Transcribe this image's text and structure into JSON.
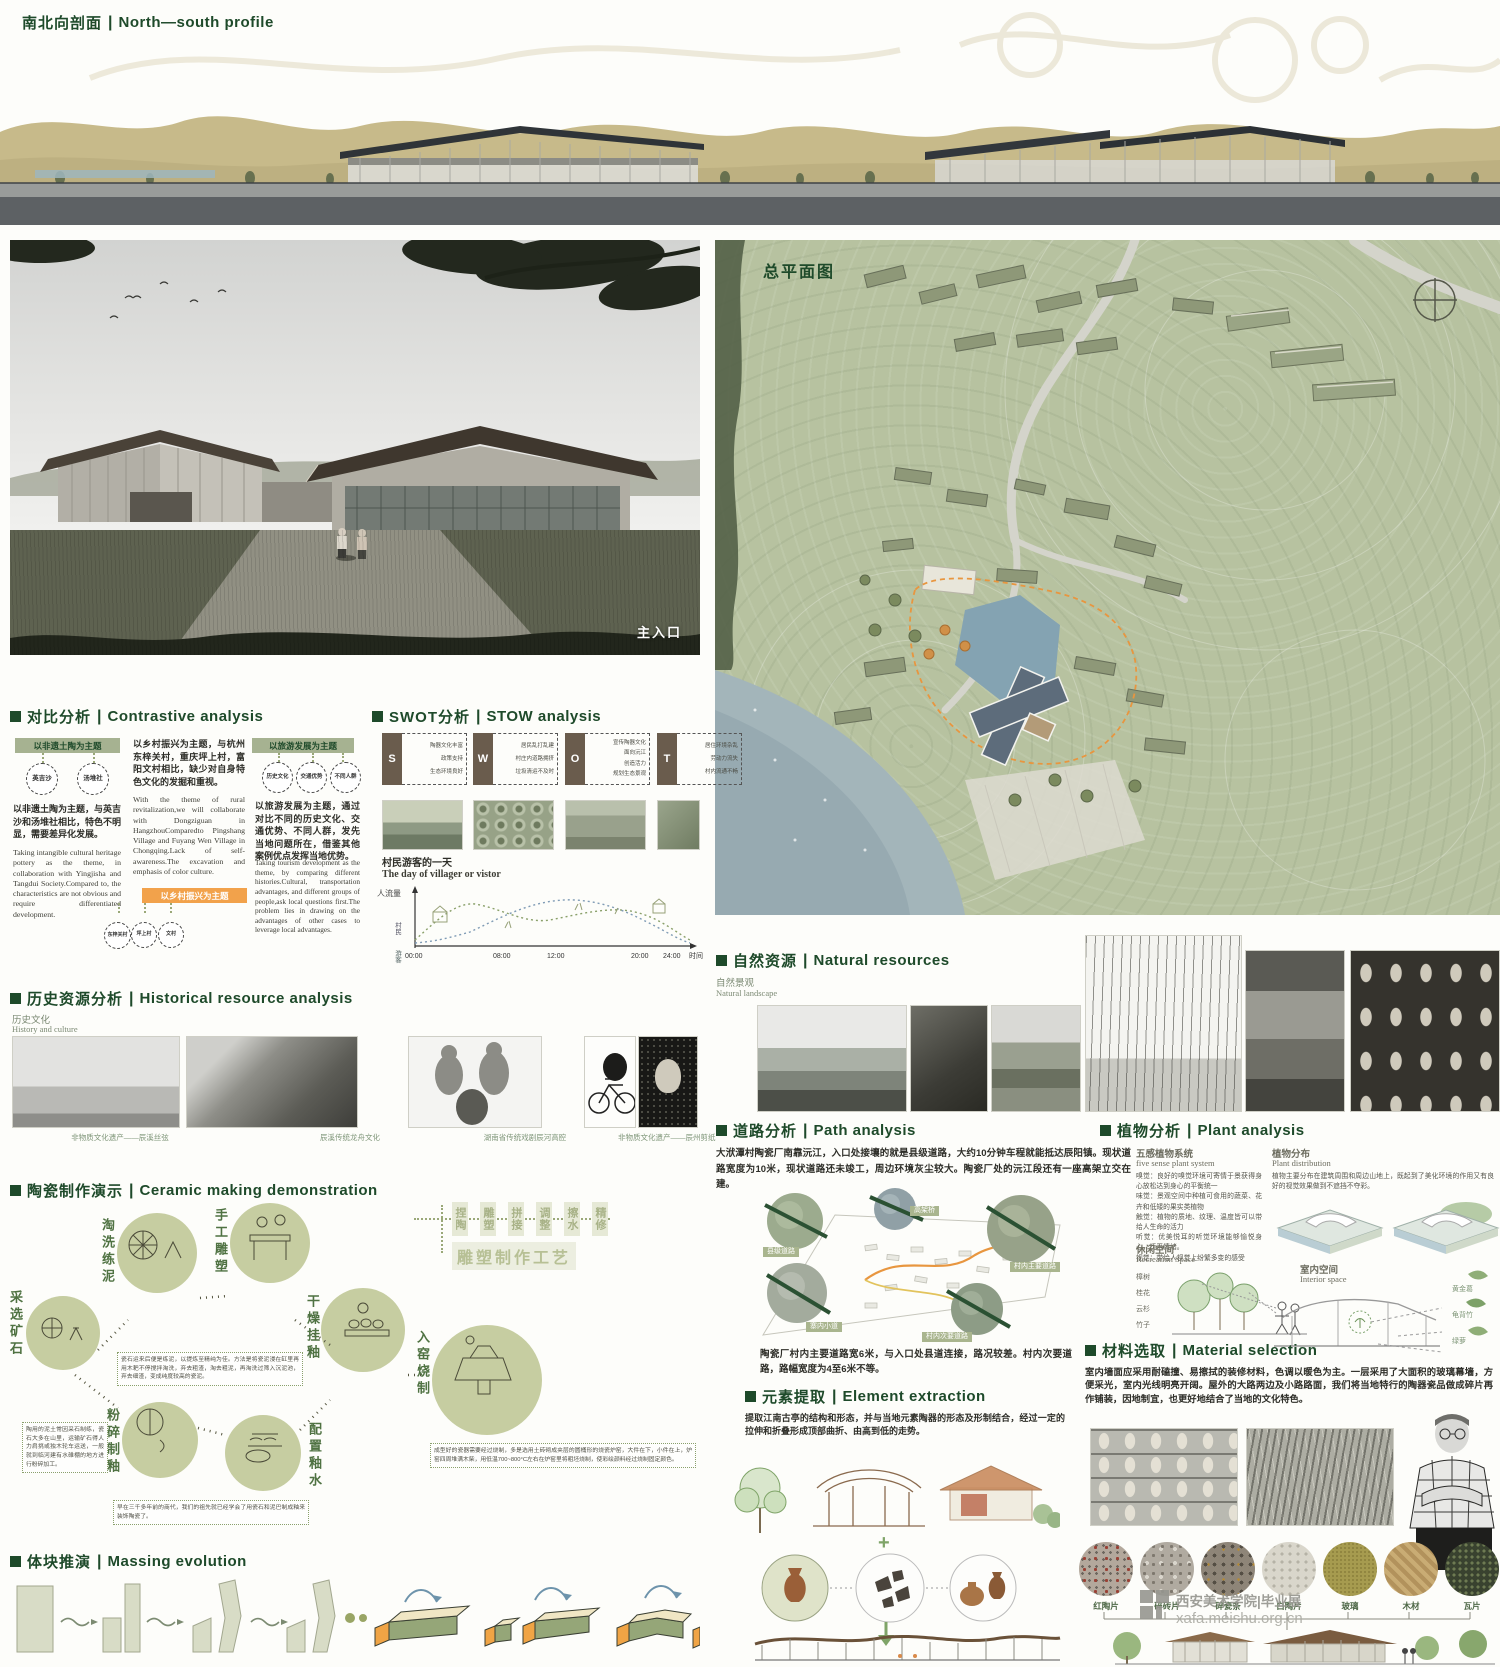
{
  "ui": {
    "sep": "|",
    "plus": "+"
  },
  "top": {
    "title_zh": "南北向剖面",
    "title_en": "North—south profile"
  },
  "render": {
    "entrance_label": "主入口"
  },
  "siteplan": {
    "title": "总平面图"
  },
  "contrastive": {
    "title_zh": "对比分析",
    "title_en": "Contrastive analysis",
    "card_pottery": {
      "header": "以非遗土陶为主题",
      "circle1": "英吉沙",
      "circle2": "汤堆社",
      "text_zh": "以非遗土陶为主题，与英吉沙和汤堆社相比，特色不明显，需要差异化发展。",
      "text_en": "Taking intangible cultural heritage pottery as the theme, in collaboration with Yingjisha and Tangdui Society.Compared to, the characteristics are not obvious and require differentiated development."
    },
    "card_rural": {
      "header": "以乡村振兴为主题",
      "circle1": "东梓关村",
      "circle2": "坪上村",
      "circle3": "文村",
      "text_zh": "以乡村振兴为主题，与杭州东梓关村，重庆坪上村，富阳文村相比，缺少对自身特色文化的发掘和重视。",
      "text_en": "With the theme of rural revitalization,we will collaborate with Dongziguan in HangzhouComparedto Pingshang Village and Fuyang Wen Village in Chongqing.Lack of self-awareness.The excavation and emphasis of color culture."
    },
    "card_tourism": {
      "header": "以旅游发展为主题",
      "circle1": "历史文化",
      "circle2": "交通优势",
      "circle3": "不同人群",
      "text_zh": "以旅游发展为主题，通过对比不同的历史文化、交通优势、不同人群，发先当地问题所在，借鉴其他案例优点发挥当地优势。",
      "text_en": "Taking tourism development as the theme, by comparing different histories.Cultural, transportation advantages, and different groups of people,ask local questions first.The problem lies in drawing on the advantages of other cases to leverage local advantages."
    }
  },
  "swot": {
    "title_zh": "SWOT分析",
    "title_en": "STOW analysis",
    "cards": [
      {
        "letter": "S",
        "i1": "陶器文化丰富",
        "i2": "政策支持",
        "i3": "生态环境良好"
      },
      {
        "letter": "W",
        "i1": "居民乱打乱建",
        "i2": "村庄内道路拥挤",
        "i3": "垃圾清运不及时"
      },
      {
        "letter": "O",
        "i1": "宣传陶器文化",
        "i2": "面向沅江",
        "i3": "创造活力",
        "i4": "规划生态景观"
      },
      {
        "letter": "T",
        "i1": "居住环境杂乱",
        "i2": "劳动力流失",
        "i3": "村内流通不畅"
      }
    ],
    "day": {
      "title_zh": "村民游客的一天",
      "title_en": "The day of villager or vistor",
      "y_label": "人流量",
      "x_label": "时间",
      "legend_villager": "村民",
      "legend_visitor": "游客",
      "ticks": [
        "00:00",
        "08:00",
        "12:00",
        "20:00",
        "24:00"
      ]
    },
    "day_chart": {
      "type": "line",
      "x_hours": [
        0,
        2,
        4,
        6,
        8,
        10,
        12,
        14,
        16,
        18,
        20,
        22,
        24
      ],
      "series": [
        {
          "name": "村民",
          "values": [
            0.1,
            0.1,
            0.2,
            0.6,
            0.7,
            0.5,
            0.45,
            0.5,
            0.6,
            0.5,
            0.3,
            0.15,
            0.1
          ]
        },
        {
          "name": "游客",
          "values": [
            0,
            0,
            0.05,
            0.1,
            0.4,
            0.7,
            0.8,
            0.75,
            0.7,
            0.5,
            0.25,
            0.1,
            0.05
          ]
        }
      ],
      "xlabel": "时间",
      "ylabel": "人流量"
    }
  },
  "history": {
    "title_zh": "历史资源分析",
    "title_en": "Historical resource analysis",
    "sub_zh": "历史文化",
    "sub_en": "History and culture",
    "captions": [
      "非物质文化遗产——辰溪丝弦",
      "辰溪传统龙舟文化",
      "湖南省传统戏剧辰河高腔",
      "非物质文化遗产——辰州剪纸"
    ]
  },
  "ceramic": {
    "title_zh": "陶瓷制作演示",
    "title_en": "Ceramic making demonstration",
    "steps": [
      "采选矿石",
      "淘洗练泥",
      "手工雕塑",
      "粉碎制釉",
      "配置釉水",
      "干燥挂釉",
      "入窑烧制"
    ],
    "flow": [
      "捏陶",
      "雕塑",
      "拼接",
      "调整",
      "擦水",
      "精修"
    ],
    "flow_result": "雕塑制作工艺",
    "note_mine": "陶用的泥土常因采石制练，瓷石大多在山里，运输矿石得人力肩挑或独木轮车运送，一般就到临河建有水碓棚的地方进行粉碎加工。",
    "note_clay": "瓷石运来后便是练泥，以提炼至精纯为佳。方法是将瓷泥浸在缸里再用木耙不停搅拌淘洗，弃去粗渣，淘去粗泥，再淘洗过筛入沉泥池，弃去细渣，变成纯度较高的瓷泥。",
    "note_glaze": "早在三千多年前的商代，我们的祖先就已经学会了用瓷石和泥巴制成釉来装饰陶瓷了。",
    "note_kiln": "成型好的瓷器需要经过烧制，多是选用土砖砌成夹层的圆桶形的烧瓷炉窑，大件在下，小件在上，炉窑四周堆满木柴，用低温700~800°C左右在炉窑里将粗坯烧制，使彩绘颜料经过烧制固定颜色。"
  },
  "massing": {
    "title_zh": "体块推演",
    "title_en": "Massing evolution"
  },
  "natural": {
    "title_zh": "自然资源",
    "title_en": "Natural resources",
    "sub_zh": "自然景观",
    "sub_en": "Natural landscape"
  },
  "path": {
    "title_zh": "道路分析",
    "title_en": "Path analysis",
    "p1": "大洑潭村陶瓷厂南靠沅江，入口处接壤的就是县级道路，大约10分钟车程就能抵达辰阳镇。现状道路宽度为10米，现状道路还未竣工，周边环境灰尘较大。陶瓷厂处的沅江段还有一座高架立交在建。",
    "p2": "陶瓷厂村内主要道路宽6米，与入口处县道连接，路况较差。村内次要道路，路幅宽度为4至6米不等。",
    "labels": [
      "县级道路",
      "高架桥",
      "村内主要道路",
      "寨内小道",
      "村内次要道路"
    ]
  },
  "plant": {
    "title_zh": "植物分析",
    "title_en": "Plant analysis",
    "five_zh": "五感植物系统",
    "five_en": "five sense plant system",
    "five_text": "嗅觉：良好的嗅觉环境可寄情于景获得身心放松达到身心的平衡统一\n味觉：景观空间中种植可食用的蔬菜、花卉和低矮的果实类植物\n触觉：植物的质地、纹理、温度皆可以带给人生命的活力\n听觉：优美悦耳的听觉环境能够愉悦身心，抚平情绪。\n视觉：带给人视觉上纷繁多变的感受",
    "dist_zh": "植物分布",
    "dist_en": "Plant distribution",
    "dist_text": "植物主要分布在建筑周围和周边山地上，既起到了美化环境的作用又有良好的视觉效果做到不遮挡不夺彩。",
    "rec_zh": "休闲空间",
    "rec_en": "Recreation Space",
    "int_zh": "室内空间",
    "int_en": "Interior space",
    "plants_outdoor": [
      "樟树",
      "桂花",
      "云杉",
      "竹子"
    ],
    "plants_indoor": [
      "黄金葛",
      "龟背竹",
      "绿萝"
    ]
  },
  "element": {
    "title_zh": "元素提取",
    "title_en": "Element extraction",
    "text": "提取江南古亭的结构和形态，并与当地元素陶器的形态及形制结合，经过一定的拉伸和折叠形成顶部曲折、由高到低的走势。"
  },
  "material": {
    "title_zh": "材料选取",
    "title_en": "Material selection",
    "text": "室内墙面应采用耐磕撞、易擦拭的装修材料，色调以暖色为主。一层采用了大面积的玻璃幕墙，方便采光，室内光线明亮开阔。屋外的大路两边及小路路面，我们将当地特行的陶器瓷品做成碎片再作铺装，因地制宜，也更好地结合了当地的文化特色。",
    "swatches": [
      "红陶片",
      "碎砖片",
      "碎瓷条",
      "白陶片",
      "玻璃",
      "木材",
      "瓦片"
    ]
  },
  "watermark": {
    "line1": "西安美术学院|毕业展",
    "line2": "xafa.meishu.org.cn"
  }
}
